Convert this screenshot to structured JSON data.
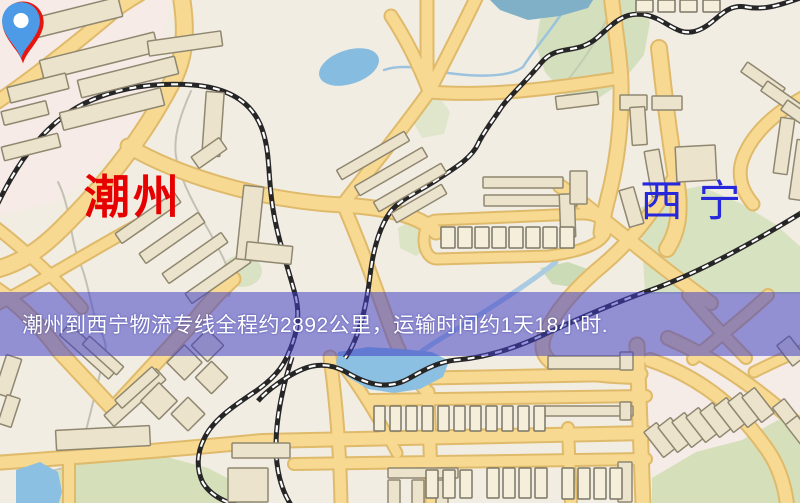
{
  "banner": {
    "text": "潮州到西宁物流专线全程约2892公里，运输时间约1天18小时.",
    "background": "#403ec6",
    "text_color": "#ffffff"
  },
  "markers": {
    "origin": {
      "label": "潮州",
      "pin_color": "#e8150f",
      "label_color": "#e60000"
    },
    "destination": {
      "label": "西宁",
      "pin_color": "#4d9be6",
      "label_color": "#2727dc"
    }
  },
  "map": {
    "background": "#f2ede3",
    "palette": {
      "road_fill": "#f7d992",
      "road_case": "#dfba6b",
      "rail_dark": "#262626",
      "rail_light": "#ffffff",
      "bld_fill": "#ebe3cb",
      "bld_stroke": "#8f8770",
      "light_fill": "#f4eeda",
      "light_stroke": "#7c7666",
      "green": "#d9e2c2",
      "water": "#8abede",
      "water_stroke": "#6fa6cc",
      "stream_gray": "#c3c1b4",
      "stream_blue": "#9cc3de"
    },
    "patches": [
      {
        "p": [
          [
            0,
            0
          ],
          [
            170,
            0
          ],
          [
            150,
            120
          ],
          [
            60,
            200
          ],
          [
            0,
            215
          ]
        ],
        "c": "#f6ebe6"
      },
      {
        "p": [
          [
            620,
            356
          ],
          [
            800,
            356
          ],
          [
            800,
            500
          ],
          [
            640,
            470
          ]
        ],
        "c": "#f5ebe7"
      }
    ],
    "greens": [
      {
        "p": [
          [
            540,
            20
          ],
          [
            562,
            2
          ],
          [
            578,
            -4
          ],
          [
            636,
            -4
          ],
          [
            650,
            22
          ],
          [
            644,
            55
          ],
          [
            622,
            82
          ],
          [
            596,
            100
          ],
          [
            566,
            96
          ],
          [
            545,
            72
          ],
          [
            536,
            45
          ]
        ],
        "c": "#d3dfbd"
      },
      {
        "p": [
          [
            640,
            208
          ],
          [
            672,
            192
          ],
          [
            700,
            186
          ],
          [
            742,
            204
          ],
          [
            775,
            224
          ],
          [
            802,
            248
          ],
          [
            802,
            294
          ],
          [
            645,
            294
          ]
        ],
        "c": "#d7e2c0"
      },
      {
        "p": [
          [
            42,
            478
          ],
          [
            86,
            458
          ],
          [
            148,
            452
          ],
          [
            208,
            468
          ],
          [
            246,
            488
          ],
          [
            252,
            506
          ],
          [
            40,
            506
          ]
        ],
        "c": "#d5e0ba"
      },
      {
        "p": [
          [
            652,
            478
          ],
          [
            696,
            452
          ],
          [
            742,
            440
          ],
          [
            778,
            420
          ],
          [
            802,
            424
          ],
          [
            802,
            506
          ],
          [
            652,
            506
          ]
        ],
        "c": "#d5e0ba"
      },
      {
        "e": [
          242,
          271,
          20,
          16,
          0
        ],
        "c": "#d9e2c2"
      },
      {
        "p": [
          [
            398,
            228
          ],
          [
            414,
            219
          ],
          [
            430,
            226
          ],
          [
            432,
            246
          ],
          [
            416,
            256
          ],
          [
            400,
            248
          ]
        ],
        "c": "#dce4c6"
      },
      {
        "p": [
          [
            416,
            102
          ],
          [
            440,
            98
          ],
          [
            450,
            112
          ],
          [
            444,
            134
          ],
          [
            422,
            138
          ],
          [
            412,
            120
          ]
        ],
        "c": "#e0e6cc"
      },
      {
        "p": [
          [
            540,
            268
          ],
          [
            568,
            262
          ],
          [
            596,
            272
          ],
          [
            580,
            288
          ],
          [
            552,
            284
          ]
        ],
        "c": "#cadbb6"
      }
    ],
    "streams": [
      {
        "d": "M191,91 C179,118 172,141 177,161 C186,200 218,240 229,272 C232,282 231,290 229,296",
        "c": "#c3c1b4",
        "w": 2
      },
      {
        "d": "M58,182 C72,210 69,240 82,268 C90,290 91,312 101,332 C108,346 106,354 103,362 C95,393 89,421 81,449 C75,467 58,471 44,471",
        "c": "#c3c1b4",
        "w": 2
      },
      {
        "d": "M610,12 C598,40 580,66 561,88",
        "c": "#c2cdb2",
        "w": 2
      },
      {
        "d": "M562,13 C548,34 532,52 523,67 C505,80 462,76 430,70 C414,67 398,65 384,70",
        "c": "#9cc3de",
        "w": 2.5
      },
      {
        "d": "M556,262 C530,283 495,305 468,322 C448,335 432,343 421,352",
        "c": "#aacbe2",
        "w": 5
      }
    ],
    "roads": [
      {
        "d": "M181,-6 C187,30 186,58 170,86 C138,146 100,190 62,228 C38,252 18,264 -6,270",
        "w": 15
      },
      {
        "d": "M-6,104 C30,80 70,48 106,18 C116,9 126,2 140,-6",
        "w": 12
      },
      {
        "d": "M128,146 C172,172 252,200 342,205 C398,208 424,220 436,232",
        "w": 13
      },
      {
        "d": "M-6,226 C25,250 55,278 82,308",
        "w": 10
      },
      {
        "d": "M-6,306 C45,280 95,248 140,224",
        "w": 10
      },
      {
        "d": "M391,16 C408,42 420,68 429,91",
        "w": 11
      },
      {
        "d": "M427,-6 L427,60 C427,76 428,85 429,92",
        "w": 11
      },
      {
        "d": "M429,92 C444,62 462,28 478,-6",
        "w": 11
      },
      {
        "d": "M429,92 C402,130 371,168 343,204",
        "w": 11
      },
      {
        "d": "M430,92 C490,97 555,88 614,79",
        "w": 11
      },
      {
        "d": "M611,-6 C615,30 620,55 621,82 C622,125 617,165 607,202 C604,214 602,224 601,233",
        "w": 13
      },
      {
        "d": "M437,220 L578,214 C600,213 610,224 605,234 C599,245 579,252 548,256 L437,259 C429,259 424,250 424,240 C424,229 429,220 437,220 Z",
        "w": 9
      },
      {
        "d": "M659,48 C664,95 670,140 677,185 C681,212 678,232 667,249",
        "w": 14
      },
      {
        "d": "M560,186 C595,212 631,242 664,268 C686,285 701,296 711,303",
        "w": 12
      },
      {
        "d": "M673,180 C652,214 630,242 604,264 C575,288 556,310 546,332 C539,347 543,356 552,363 C566,372 600,376 636,377",
        "w": 12
      },
      {
        "d": "M688,295 C705,315 726,338 746,358",
        "w": 10
      },
      {
        "d": "M768,295 C746,316 716,339 693,359",
        "w": 10
      },
      {
        "d": "M806,96 C776,112 753,132 743,158 C737,174 741,190 753,204",
        "w": 11
      },
      {
        "d": "M343,204 C362,248 376,288 391,330 C400,357 415,378 428,393",
        "w": 11
      },
      {
        "d": "M-6,288 C16,302 41,326 59,351 L113,409 L196,319 C210,301 222,289 233,279",
        "w": 13
      },
      {
        "d": "M-6,463 C80,457 180,449 262,441 L646,433",
        "w": 12
      },
      {
        "d": "M294,464 L646,459",
        "w": 10
      },
      {
        "d": "M428,378 L641,374",
        "w": 11
      },
      {
        "d": "M370,400 L646,396",
        "w": 10
      },
      {
        "d": "M330,357 C336,400 340,450 341,504",
        "w": 11
      },
      {
        "d": "M428,392 L432,504",
        "w": 11
      },
      {
        "d": "M346,370 C365,395 382,425 397,453",
        "w": 9
      },
      {
        "d": "M637,345 L643,504",
        "w": 13
      },
      {
        "d": "M568,428 L571,504",
        "w": 10
      },
      {
        "d": "M69,458 L69,504",
        "w": 10
      },
      {
        "d": "M650,360 C700,377 738,408 766,448 C777,463 784,481 787,504",
        "w": 12
      },
      {
        "d": "M668,338 C718,360 761,391 806,432",
        "w": 12
      },
      {
        "d": "M754,372 C776,361 791,354 806,349",
        "w": 9
      }
    ],
    "water": [
      {
        "p": [
          [
            487,
            -3
          ],
          [
            595,
            -3
          ],
          [
            588,
            8
          ],
          [
            560,
            16
          ],
          [
            528,
            20
          ],
          [
            500,
            10
          ]
        ],
        "c": "#7fb0c8"
      },
      {
        "e": [
          349,
          67,
          31,
          17,
          -18
        ],
        "c": "#85bce0"
      },
      {
        "p": [
          [
            338,
            352
          ],
          [
            368,
            347
          ],
          [
            402,
            349
          ],
          [
            432,
            352
          ],
          [
            449,
            361
          ],
          [
            443,
            377
          ],
          [
            420,
            389
          ],
          [
            394,
            393
          ],
          [
            368,
            389
          ],
          [
            346,
            376
          ],
          [
            336,
            363
          ]
        ],
        "c": "#8cc0e2"
      },
      {
        "p": [
          [
            16,
            470
          ],
          [
            40,
            462
          ],
          [
            58,
            472
          ],
          [
            62,
            492
          ],
          [
            58,
            506
          ],
          [
            16,
            506
          ]
        ],
        "c": "#8cc0e2"
      }
    ],
    "railways": [
      {
        "d": "M-8,216 C10,176 32,140 64,116 C102,88 152,82 193,85 C230,88 254,103 263,132 C270,154 268,174 272,202 C276,234 287,264 295,294 C300,312 298,332 289,352 C283,369 270,381 256,391 C232,407 212,421 204,439 C197,453 196,469 203,483 C210,494 222,501 236,505"
      },
      {
        "d": "M292,357 C283,386 276,416 276,446 C276,471 282,491 291,505"
      },
      {
        "d": "M806,-4 C786,3 766,11 746,7 C723,3 716,25 696,31 C677,37 666,19 646,15 C624,11 614,23 598,37 C577,56 557,43 541,63 C522,86 506,99 499,111 C491,123 483,133 478,144 C471,159 453,169 435,181 C416,193 401,199 391,211 C379,227 373,251 370,276 C368,293 365,311 359,329 C354,344 349,353 345,358"
      },
      {
        "d": "M806,210 C761,238 701,272 651,290 C611,304 571,322 541,336 C511,350 481,358 456,360 C436,362 421,372 406,380 C386,390 366,384 346,372 C321,358 301,368 283,380 C271,388 263,395 258,401"
      }
    ],
    "buildings_tan": [
      [
        12,
        10,
        110,
        20,
        -14
      ],
      [
        40,
        46,
        118,
        20,
        -14
      ],
      [
        8,
        80,
        60,
        16,
        -14
      ],
      [
        78,
        68,
        100,
        18,
        -14
      ],
      [
        2,
        106,
        46,
        14,
        -14
      ],
      [
        60,
        100,
        104,
        18,
        -14
      ],
      [
        2,
        140,
        58,
        14,
        -14
      ],
      [
        148,
        36,
        74,
        15,
        -8
      ],
      [
        204,
        92,
        18,
        64,
        4
      ],
      [
        192,
        146,
        34,
        14,
        -35
      ],
      [
        112,
        212,
        72,
        12,
        -35
      ],
      [
        136,
        232,
        72,
        12,
        -35
      ],
      [
        159,
        252,
        72,
        12,
        -35
      ],
      [
        182,
        272,
        72,
        12,
        -35
      ],
      [
        334,
        150,
        78,
        11,
        -30
      ],
      [
        352,
        166,
        78,
        11,
        -30
      ],
      [
        371,
        182,
        78,
        11,
        -30
      ],
      [
        390,
        198,
        58,
        11,
        -30
      ],
      [
        240,
        186,
        20,
        74,
        6
      ],
      [
        246,
        244,
        46,
        18,
        6
      ],
      [
        483,
        177,
        80,
        11,
        0
      ],
      [
        484,
        195,
        93,
        11,
        0
      ],
      [
        556,
        94,
        42,
        13,
        -7
      ],
      [
        620,
        95,
        27,
        15,
        0
      ],
      [
        652,
        96,
        30,
        14,
        0
      ],
      [
        631,
        107,
        15,
        38,
        -4
      ],
      [
        648,
        150,
        15,
        46,
        -10
      ],
      [
        624,
        188,
        15,
        38,
        -16
      ],
      [
        676,
        146,
        40,
        35,
        -3
      ],
      [
        560,
        194,
        15,
        43,
        -2
      ],
      [
        570,
        171,
        17,
        33,
        0
      ],
      [
        740,
        74,
        46,
        12,
        35
      ],
      [
        760,
        93,
        46,
        12,
        35
      ],
      [
        780,
        112,
        46,
        12,
        35
      ],
      [
        777,
        118,
        14,
        56,
        8
      ],
      [
        793,
        140,
        14,
        60,
        8
      ],
      [
        56,
        344,
        66,
        15,
        42
      ],
      [
        100,
        390,
        70,
        15,
        -42
      ],
      [
        80,
        350,
        46,
        11,
        42
      ],
      [
        112,
        382,
        50,
        11,
        -42
      ],
      [
        146,
        388,
        26,
        26,
        45
      ],
      [
        176,
        402,
        24,
        24,
        45
      ],
      [
        172,
        350,
        25,
        25,
        45
      ],
      [
        200,
        366,
        23,
        23,
        45
      ],
      [
        196,
        334,
        23,
        23,
        45
      ],
      [
        56,
        428,
        94,
        20,
        -3
      ],
      [
        0,
        356,
        16,
        40,
        18
      ],
      [
        2,
        396,
        14,
        30,
        18
      ],
      [
        548,
        356,
        84,
        13,
        0
      ],
      [
        543,
        406,
        90,
        10,
        0
      ],
      [
        232,
        443,
        58,
        15,
        0
      ],
      [
        228,
        468,
        40,
        34,
        0
      ],
      [
        388,
        468,
        70,
        10,
        0
      ],
      [
        388,
        480,
        12,
        24,
        0
      ],
      [
        412,
        480,
        12,
        24,
        0
      ],
      [
        436,
        480,
        12,
        24,
        0
      ],
      [
        652,
        424,
        16,
        32,
        -38
      ],
      [
        666,
        419,
        16,
        32,
        -38
      ],
      [
        680,
        414,
        16,
        32,
        -38
      ],
      [
        694,
        409,
        16,
        32,
        -38
      ],
      [
        708,
        404,
        16,
        32,
        -38
      ],
      [
        722,
        399,
        16,
        32,
        -38
      ],
      [
        736,
        394,
        16,
        32,
        -38
      ],
      [
        750,
        389,
        16,
        32,
        -38
      ],
      [
        780,
        400,
        15,
        30,
        -38
      ],
      [
        793,
        417,
        15,
        30,
        -38
      ],
      [
        783,
        338,
        16,
        26,
        -38
      ],
      [
        620,
        352,
        13,
        18,
        0
      ],
      [
        620,
        402,
        11,
        18,
        0
      ],
      [
        618,
        462,
        14,
        40,
        0
      ]
    ],
    "buildings_light": [
      [
        441,
        227,
        14,
        21,
        0
      ],
      [
        458,
        227,
        14,
        21,
        0
      ],
      [
        475,
        227,
        14,
        21,
        0
      ],
      [
        492,
        227,
        14,
        21,
        0
      ],
      [
        509,
        227,
        14,
        21,
        0
      ],
      [
        526,
        227,
        14,
        21,
        0
      ],
      [
        543,
        227,
        14,
        21,
        0
      ],
      [
        560,
        227,
        14,
        21,
        0
      ],
      [
        636,
        0,
        17,
        12,
        0
      ],
      [
        658,
        0,
        17,
        12,
        0
      ],
      [
        680,
        0,
        17,
        12,
        0
      ],
      [
        703,
        0,
        17,
        12,
        0
      ],
      [
        374,
        406,
        11,
        25,
        0
      ],
      [
        390,
        406,
        11,
        25,
        0
      ],
      [
        406,
        406,
        11,
        25,
        0
      ],
      [
        422,
        406,
        11,
        25,
        0
      ],
      [
        438,
        406,
        11,
        25,
        0
      ],
      [
        454,
        406,
        11,
        25,
        0
      ],
      [
        470,
        406,
        11,
        25,
        0
      ],
      [
        486,
        406,
        11,
        25,
        0
      ],
      [
        502,
        406,
        11,
        25,
        0
      ],
      [
        518,
        406,
        11,
        25,
        0
      ],
      [
        534,
        406,
        11,
        25,
        0
      ],
      [
        426,
        470,
        12,
        28,
        0
      ],
      [
        443,
        470,
        12,
        28,
        0
      ],
      [
        460,
        470,
        12,
        28,
        0
      ],
      [
        487,
        468,
        12,
        30,
        0
      ],
      [
        503,
        468,
        12,
        30,
        0
      ],
      [
        519,
        468,
        12,
        30,
        0
      ],
      [
        535,
        468,
        12,
        30,
        0
      ],
      [
        562,
        468,
        12,
        31,
        0
      ],
      [
        578,
        468,
        12,
        31,
        0
      ],
      [
        594,
        468,
        12,
        31,
        0
      ],
      [
        610,
        468,
        12,
        31,
        0
      ]
    ]
  }
}
